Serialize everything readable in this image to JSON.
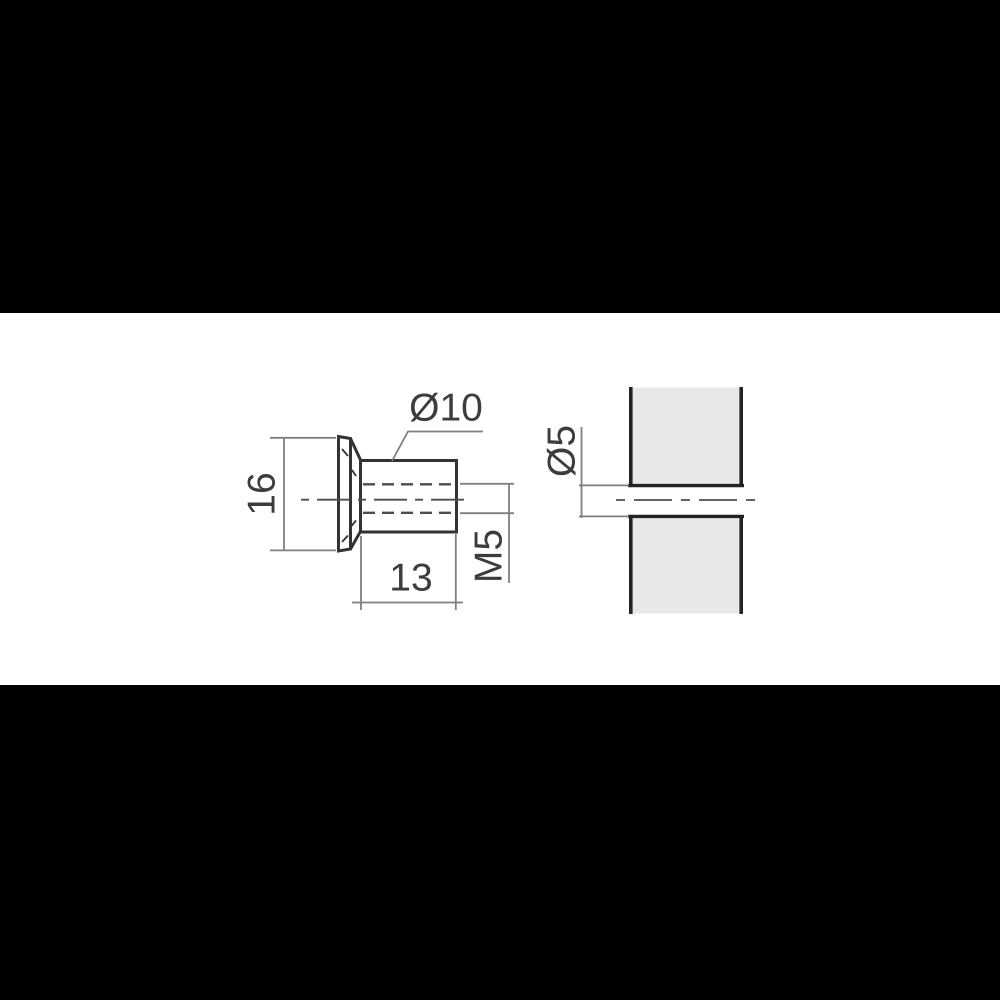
{
  "drawing": {
    "dimension_labels": {
      "head_diameter": "Ø10",
      "flange_height": "16",
      "body_length": "13",
      "thread_size": "M5",
      "hole_diameter": "Ø5"
    },
    "colors": {
      "letterbox": "#000000",
      "canvas": "#ffffff",
      "object_line": "#333333",
      "panel_line": "#242424",
      "hidden_line": "#4d4d4d",
      "center_line": "#4d4d4d",
      "dimension_line": "#7f7f7f",
      "panel_fill": "#e7e8e9",
      "text": "#3c3c3c"
    }
  }
}
